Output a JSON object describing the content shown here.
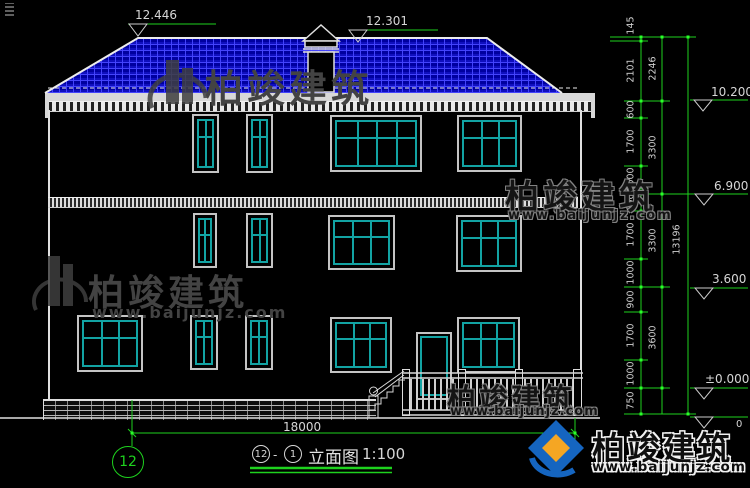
{
  "title_block": {
    "axis_left": "12",
    "separator": "-",
    "axis_right": "1",
    "name": "立面图",
    "scale": "1:100"
  },
  "axis_bubble_label": "12",
  "overall_width_dim": "18000",
  "elevations": {
    "ridge": "12.446",
    "roof_secondary": "12.301",
    "eave": "10.200",
    "floor3": "6.900",
    "floor2": "3.600",
    "ground": "±0.000",
    "basement_partial": "0"
  },
  "chain_dims": [
    "145",
    "2101",
    "600",
    "1700",
    "1000",
    "600",
    "1700",
    "1000",
    "900",
    "1700",
    "1000",
    "750"
  ],
  "group_dims": [
    "2246",
    "3300",
    "3300",
    "3600"
  ],
  "total_dim": "13196",
  "watermark": {
    "brand": "柏竣建筑",
    "url": "www.baijunjz.com"
  },
  "colors": {
    "background": "#000000",
    "roof_tile_base": "#0000A0",
    "roof_tile_grid": "#4646FF",
    "drawing_line": "#E0E0E0",
    "window_frame_teal": "#12A3A3",
    "dimension_green": "#1ED21E",
    "watermark_gray": "#434343",
    "logo_blue": "#1565C0",
    "logo_orange": "#F5A623"
  }
}
